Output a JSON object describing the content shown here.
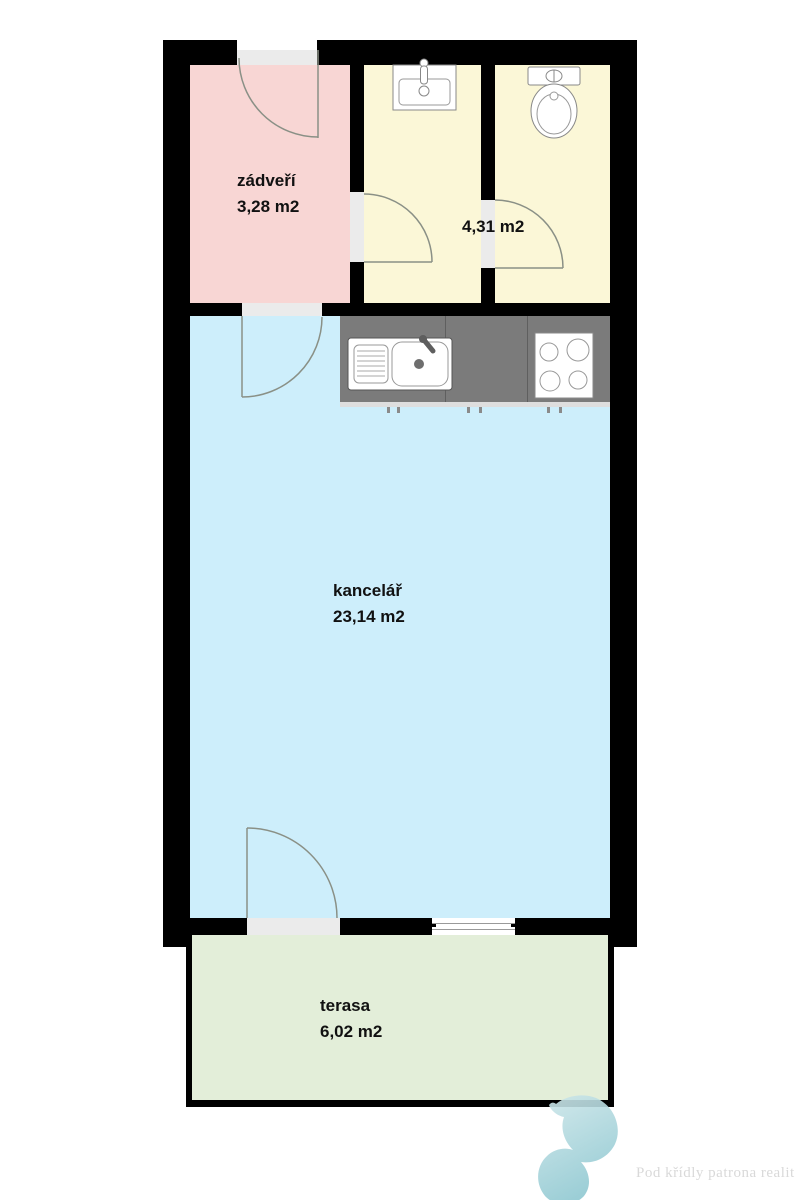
{
  "plan": {
    "background": "#ffffff",
    "wall_color": "#000000",
    "threshold_color": "#ebebeb",
    "door_arc_color": "#8a9086",
    "counter_color": "#7b7b7b",
    "rooms": {
      "zadveri": {
        "name": "zádveří",
        "area": "3,28 m2",
        "color": "#f8d6d4"
      },
      "bathroom": {
        "area": "4,31 m2",
        "color": "#fbf7d7"
      },
      "kancelar": {
        "name": "kancelář",
        "area": "23,14 m2",
        "color": "#cdeefb"
      },
      "terasa": {
        "name": "terasa",
        "area": "6,02 m2",
        "color": "#e3eed9"
      }
    },
    "fixtures": [
      "washbasin",
      "toilet",
      "kitchen-sink",
      "stove-4-burners"
    ]
  },
  "watermark": {
    "text": "Pod křídly patrona realit",
    "text_color": "#d9d9d9",
    "logo": "bird-swirl-logo",
    "logo_color_from": "#cfe7ea",
    "logo_color_to": "#8fc8d1"
  }
}
